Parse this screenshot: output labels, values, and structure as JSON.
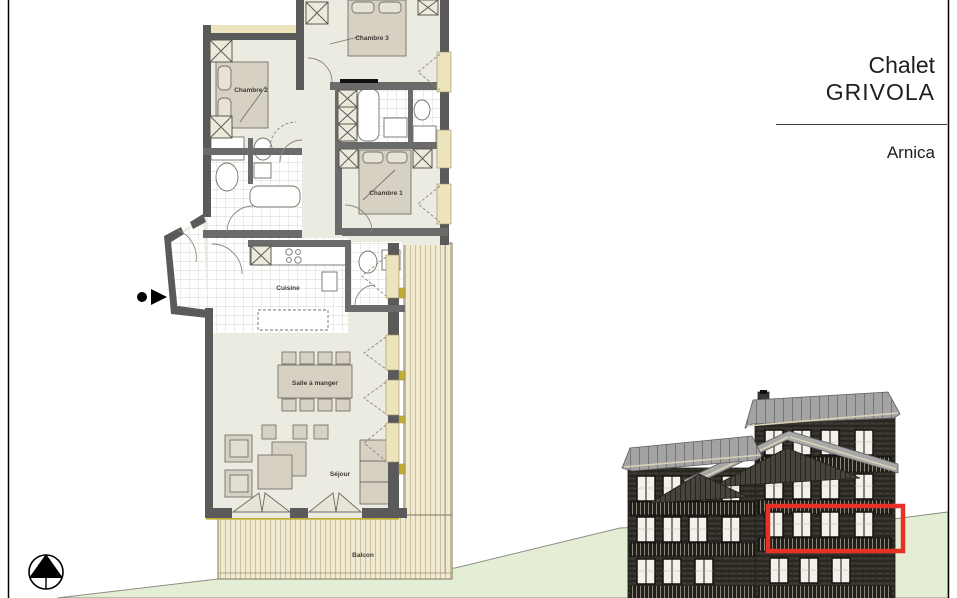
{
  "title_block": {
    "chalet_label": "Chalet",
    "chalet_name": "GRIVOLA",
    "apartment_name": "Arnica"
  },
  "plan": {
    "rooms": [
      {
        "label": "Chambre 3"
      },
      {
        "label": "Chambre 2"
      },
      {
        "label": "Chambre 1"
      },
      {
        "label": "Cuisine"
      },
      {
        "label": "Salle à manger"
      },
      {
        "label": "Séjour"
      },
      {
        "label": "Balcon"
      }
    ]
  },
  "icons": {
    "north_arrow": "north-arrow-icon",
    "entrance_arrow": "entrance-arrow-icon",
    "apartment_highlight": "apartment-highlight-box"
  },
  "colors": {
    "highlight_red": "#e73127",
    "wall_gray": "#5a5a5a",
    "floor_beige": "#ecebe1",
    "deck_cream": "#f0ead2",
    "window_cream": "#ede3bd",
    "grass_green": "#e4eed5",
    "roof_gray": "#a3a3a3",
    "facade_dark": "#2f2d28"
  }
}
